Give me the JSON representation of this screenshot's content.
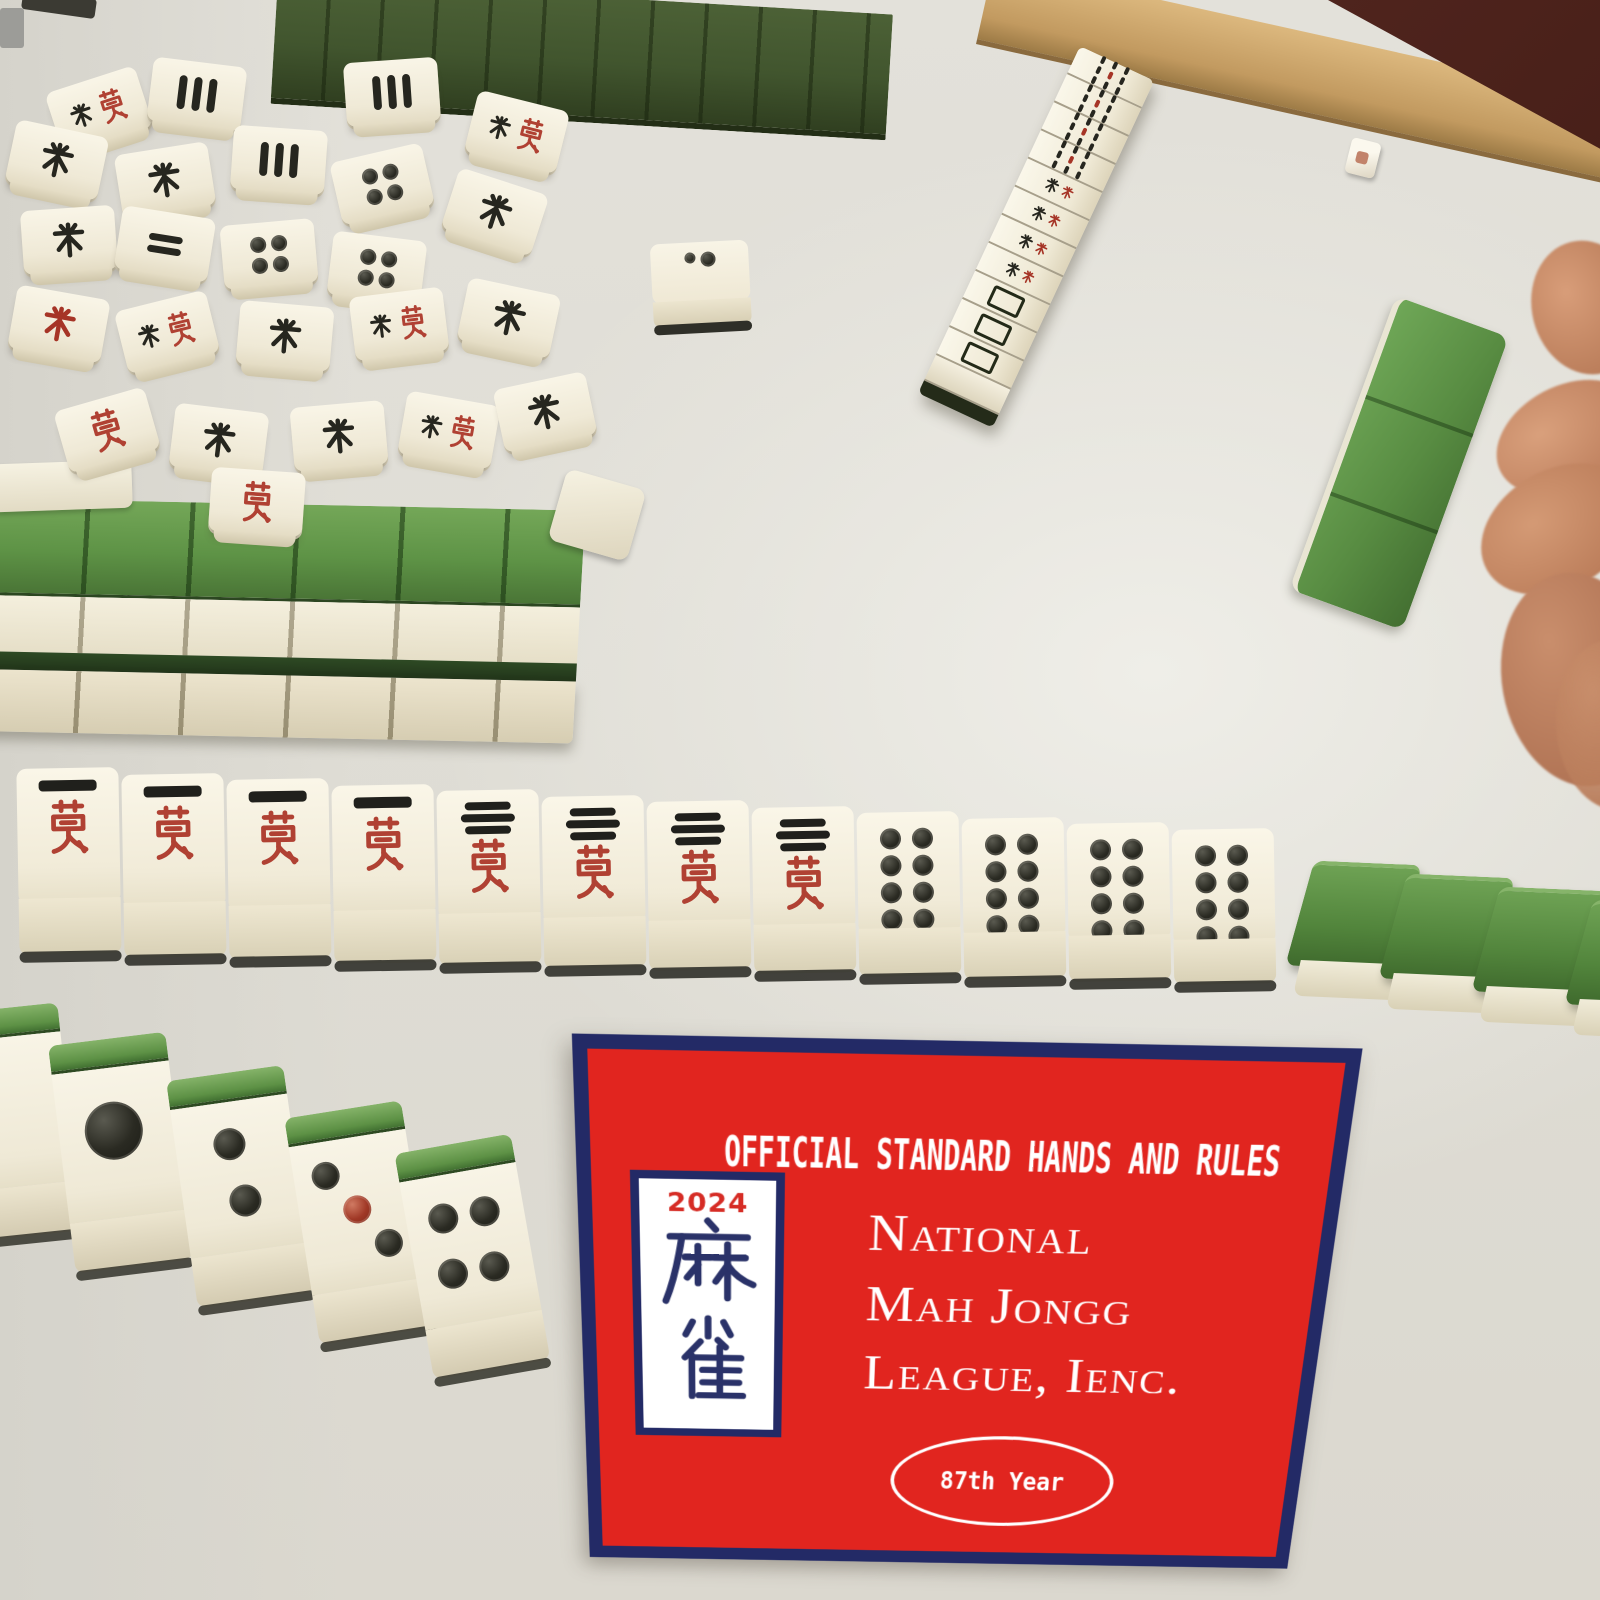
{
  "card": {
    "title": "OFFICIAL STANDARD HANDS AND RULES",
    "logo_tile": {
      "year": "2024",
      "character_top": "麻",
      "character_bottom": "雀",
      "label": "mah jongg tile logo"
    },
    "org_name_line1": "National",
    "org_name_line2": "Mah Jongg",
    "org_name_line3": "League, Ienc.",
    "badge_text": "87th Year",
    "colors": {
      "red": "#e1251f",
      "navy": "#232a66",
      "text": "#ffffff"
    }
  },
  "scene": {
    "label": "mah jongg table photo",
    "discard_row_tiles": [
      "1-man",
      "1-man",
      "1-man",
      "1-man",
      "3-man",
      "3-man",
      "3-man",
      "3-man",
      "8-dot",
      "8-dot",
      "8-dot",
      "8-dot"
    ],
    "discard_row_backs": 4,
    "rack_tiles": [
      "blank",
      "1-dot",
      "2-dot",
      "3-dot",
      "4-dot"
    ],
    "standing_rack_tiles": [
      "bamboo",
      "bamboo",
      "bamboo",
      "bamboo",
      "character",
      "character",
      "character",
      "character",
      "white-dragon",
      "white-dragon",
      "white-dragon"
    ],
    "jumble_tiles": [
      "duo-red",
      "sticks",
      "sticks",
      "duo-red",
      "mi-black",
      "mi-black",
      "sticks",
      "dots4",
      "mi-black",
      "bars2",
      "dots4",
      "dots4",
      "mi-black",
      "mi-red",
      "duo-red",
      "mi-black",
      "duo-red",
      "mi-black",
      "wan-red",
      "mi-black",
      "mi-black",
      "duo-red",
      "mi-black",
      "wan-red"
    ],
    "wall_top_tile_count": 12,
    "wall_left_tile_count": 6,
    "held_green_tiles_count": 3,
    "dice_count": 1,
    "colors": {
      "tile_ivory": "#f1ebd8",
      "tile_green": "#5e9346",
      "table": "#dedcd4",
      "rim_tan": "#c29a60",
      "background_maroon": "#5c2a22"
    }
  }
}
